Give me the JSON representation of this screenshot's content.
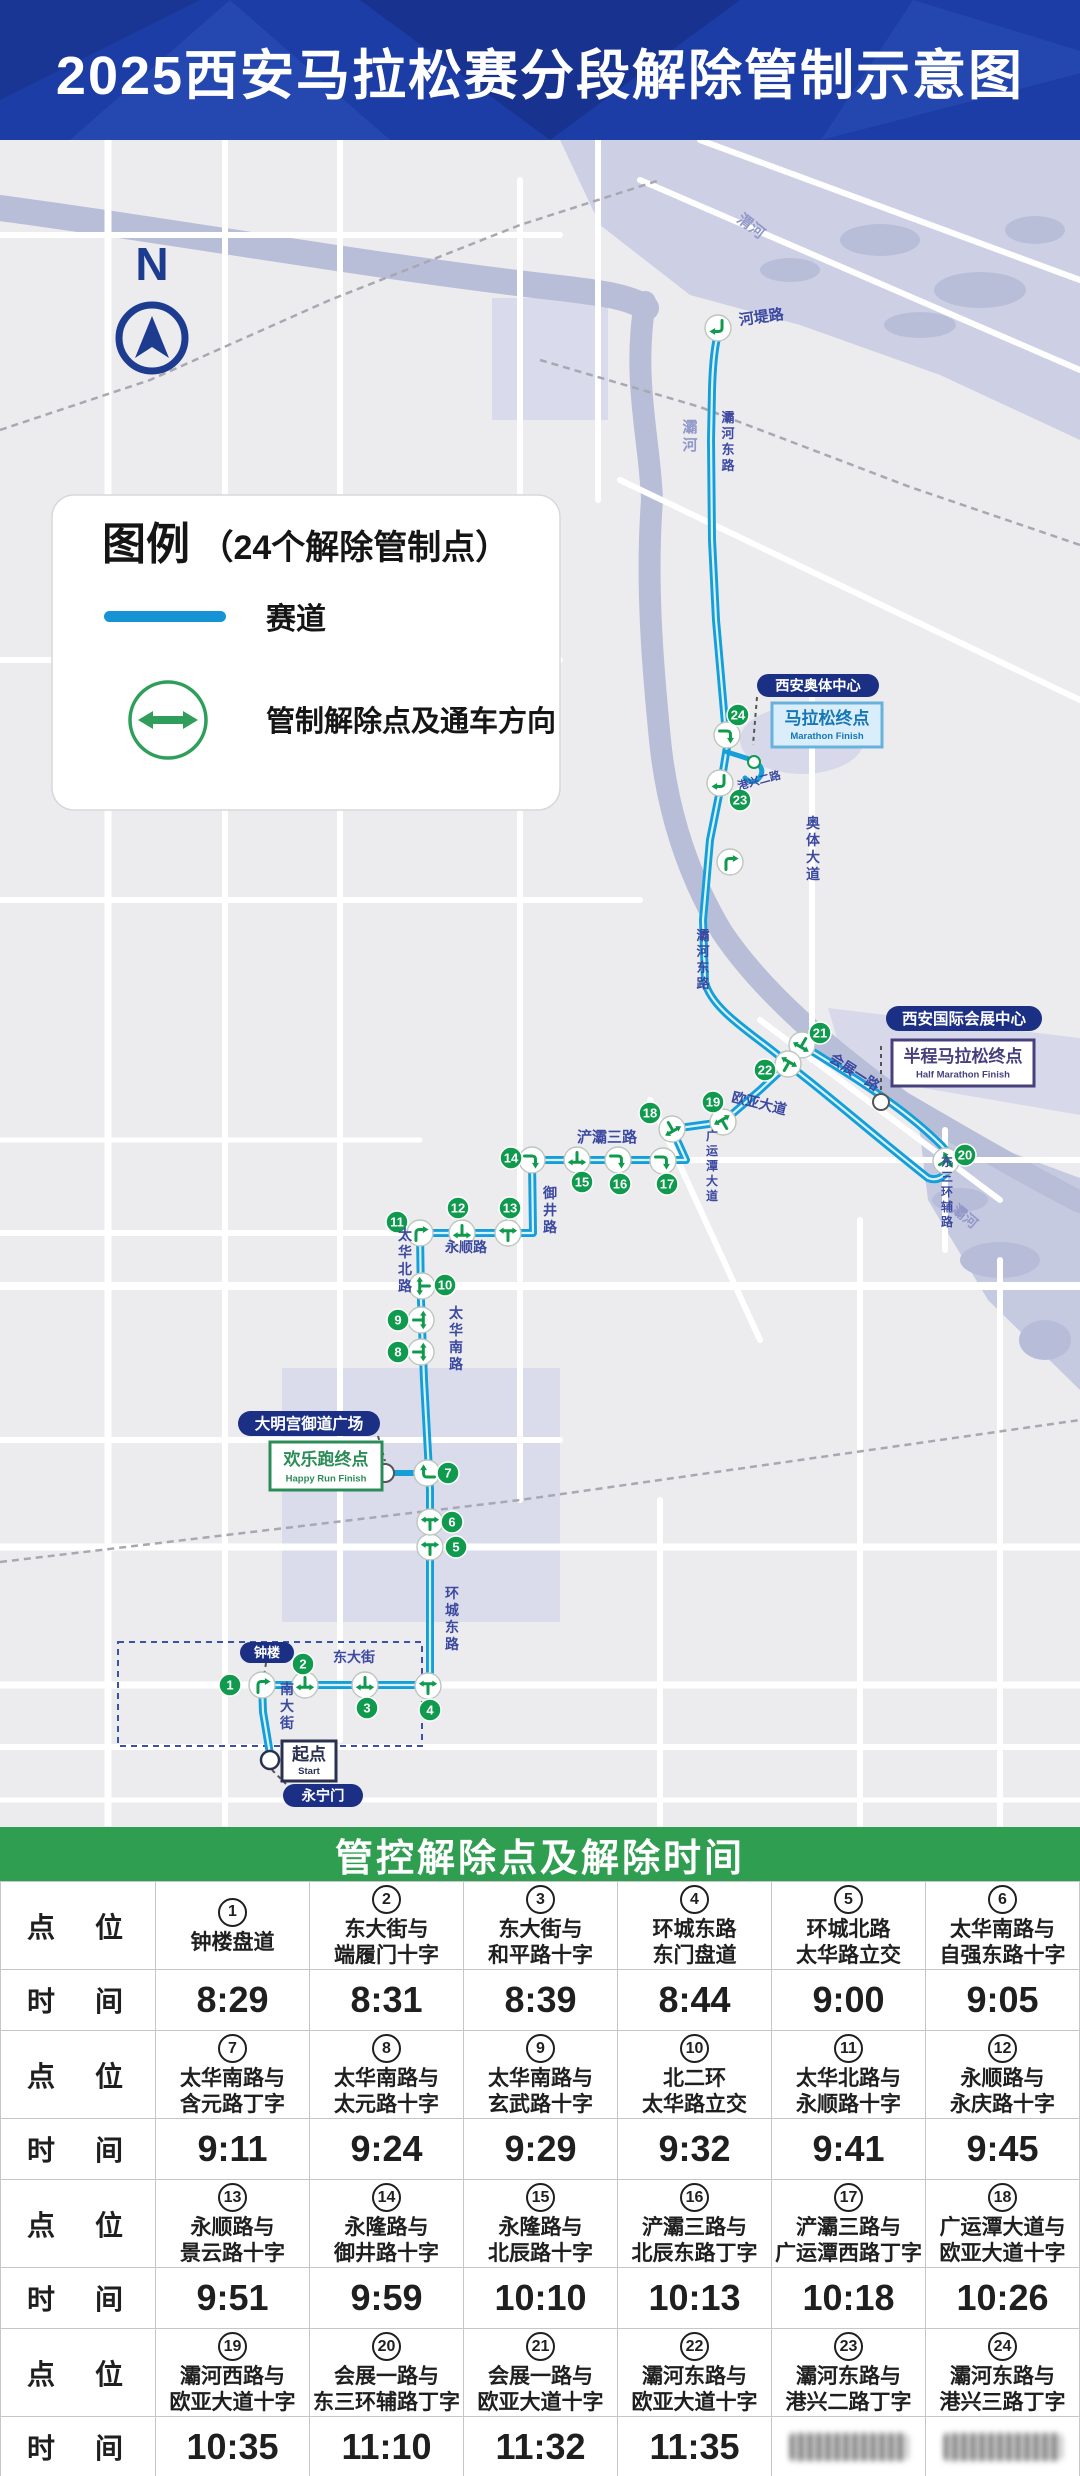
{
  "header": {
    "title": "2025西安马拉松赛分段解除管制示意图"
  },
  "colors": {
    "header_bg": "#1c3da5",
    "route": "#149fd9",
    "route_core": "#d9f1fb",
    "green": "#0f9a4e",
    "table_green": "#2f9e50",
    "navy": "#1d3c8f",
    "poi_navy": "#1b2f85",
    "road_label": "#3b49a0",
    "river_label": "#9298c8",
    "map_bg": "#ececef"
  },
  "map": {
    "compass": {
      "label": "N",
      "x": 152,
      "ytext": 140,
      "cx": 152,
      "cy": 198,
      "r": 33
    },
    "legend": {
      "x": 52,
      "y": 355,
      "w": 508,
      "h": 315,
      "title_main": "图例",
      "title_sub": "（24个解除管制点）",
      "track_label": "赛道",
      "release_label": "管制解除点及通车方向",
      "track_color": "#1593d4",
      "green": "#2f9e5a"
    },
    "patches": [
      {
        "pts": "560,0 1080,0 1080,300 940,235 800,185 690,155 600,85",
        "fill": "#cdd0e5"
      },
      {
        "pts": "492,158 608,158 608,280 492,280",
        "fill": "#d9dbec"
      },
      {
        "pts": "282,1228 560,1228 560,1482 282,1482",
        "fill": "#dadcec"
      },
      {
        "pts": "828,868 1080,898 1080,975 848,935",
        "fill": "#d7d9eb"
      },
      {
        "pts": "918,978 1080,1038 1080,1250 988,1160 928,1060",
        "fill": "#c6cae1"
      }
    ],
    "ellipses": [
      {
        "cx": 880,
        "cy": 100,
        "rx": 40,
        "ry": 16,
        "fill": "#b9bed8"
      },
      {
        "cx": 980,
        "cy": 150,
        "rx": 46,
        "ry": 18,
        "fill": "#b9bed8"
      },
      {
        "cx": 790,
        "cy": 130,
        "rx": 30,
        "ry": 12,
        "fill": "#b9bed8"
      },
      {
        "cx": 1035,
        "cy": 90,
        "rx": 30,
        "ry": 14,
        "fill": "#b9bed8"
      },
      {
        "cx": 920,
        "cy": 185,
        "rx": 36,
        "ry": 13,
        "fill": "#b9bed8"
      },
      {
        "cx": 802,
        "cy": 600,
        "rx": 62,
        "ry": 34,
        "fill": "#d7d9eb"
      },
      {
        "cx": 1000,
        "cy": 1120,
        "rx": 40,
        "ry": 18,
        "fill": "#b7bcd9"
      },
      {
        "cx": 1045,
        "cy": 1200,
        "rx": 26,
        "ry": 20,
        "fill": "#b7bcd9"
      },
      {
        "cx": 960,
        "cy": 1060,
        "rx": 28,
        "ry": 12,
        "fill": "#b7bcd9"
      }
    ],
    "rivers": [
      {
        "d": "M0,68 C180,92 380,128 560,148 C600,153 628,156 646,168",
        "w": 26
      },
      {
        "d": "M645,162 C632,240 650,300 652,360 C646,440 652,520 660,600 C668,680 692,742 722,792 C762,852 832,912 902,962 C962,997 1022,1032 1080,1062",
        "w": 22
      }
    ],
    "roads": [
      {
        "d": "M108,0 V1687",
        "w": 7
      },
      {
        "d": "M225,0 V1687",
        "w": 6
      },
      {
        "d": "M340,0 V1600",
        "w": 6
      },
      {
        "d": "M520,40 V1360",
        "w": 6
      },
      {
        "d": "M598,0 V360",
        "w": 6
      },
      {
        "d": "M860,1080 V1687",
        "w": 6
      },
      {
        "d": "M1000,1120 V1687",
        "w": 6
      },
      {
        "d": "M812,540 V920",
        "w": 6
      },
      {
        "d": "M945,990 V1110",
        "w": 6
      },
      {
        "d": "M660,1360 V1687",
        "w": 6
      },
      {
        "d": "M0,95 H560",
        "w": 6
      },
      {
        "d": "M0,520 H560",
        "w": 6
      },
      {
        "d": "M0,760 H640",
        "w": 6
      },
      {
        "d": "M0,1000 H420",
        "w": 5
      },
      {
        "d": "M0,1093 H533",
        "w": 6
      },
      {
        "d": "M0,1146 H1080",
        "w": 8
      },
      {
        "d": "M0,1300 H560",
        "w": 6
      },
      {
        "d": "M0,1407 H1080",
        "w": 7
      },
      {
        "d": "M0,1545 H1080",
        "w": 7
      },
      {
        "d": "M0,1607 H1080",
        "w": 6
      },
      {
        "d": "M0,1660 H1080",
        "w": 5
      },
      {
        "d": "M640,40 L1080,230",
        "w": 6
      },
      {
        "d": "M700,0 L1080,140",
        "w": 6
      },
      {
        "d": "M620,340 L1080,560",
        "w": 6
      },
      {
        "d": "M533,1020 H1080",
        "w": 6
      },
      {
        "d": "M650,960 L760,1200",
        "w": 6
      },
      {
        "d": "M760,880 L1000,1060",
        "w": 6
      }
    ],
    "rails": [
      {
        "d": "M0,290 L150,240 L330,160 L520,85 L660,40"
      },
      {
        "d": "M540,220 L700,267 L910,347 L1080,405"
      },
      {
        "d": "M0,1422 L520,1360 L1080,1280"
      }
    ],
    "wall": {
      "x": 118,
      "y": 1502,
      "w": 304,
      "h": 104
    },
    "route": {
      "d": "M272,1626 L263,1572 L262,1545 L430,1545 L430,1350 L424,1240 L421,1160 L420,1093 L533,1093 L532,1020 L686,1020 L672,989 L723,982 L760,950 L788,924 L802,905 C862,942 906,970 941,1005 Q957,1021 946,1033 Q938,1042 928,1038 C880,1000 842,967 808,940 Q794,929 786,922 C760,898 712,872 705,842 L703,780 L710,700 L720,650 L727,607 L723,560 L716,480 L712,400 L711,300 L712,250 Q713,212 718,194",
      "spurs": [
        {
          "d": "M727,612 Q740,616 752,620 Q766,627 760,637 Q753,646 745,638",
          "w": 5
        },
        {
          "d": "M392,1333 L415,1333",
          "w": 6
        }
      ]
    },
    "dashes": [
      {
        "d": "M266,1523 L263,1542"
      },
      {
        "d": "M378,1296 L385,1321"
      },
      {
        "d": "M272,1630 L286,1644"
      },
      {
        "d": "M757,557 L753,605"
      },
      {
        "d": "M881,906 L881,952"
      }
    ],
    "circles": [
      {
        "x": 270,
        "y": 1620,
        "r": 9,
        "s": "#2a3150",
        "w": 2.5
      },
      {
        "x": 385,
        "y": 1333,
        "r": 9,
        "s": "#555555",
        "w": 2
      },
      {
        "x": 881,
        "y": 962,
        "r": 8,
        "s": "#555555",
        "w": 2
      },
      {
        "x": 754,
        "y": 622,
        "r": 6,
        "s": "#0f9a4e",
        "w": 2
      }
    ],
    "junctions": [
      {
        "x": 262,
        "y": 1545,
        "t": "turn",
        "r": 0
      },
      {
        "x": 305,
        "y": 1545,
        "t": "tee",
        "r": 180
      },
      {
        "x": 365,
        "y": 1545,
        "t": "tee",
        "r": 180
      },
      {
        "x": 428,
        "y": 1546,
        "t": "tee",
        "r": 0
      },
      {
        "x": 430,
        "y": 1407,
        "t": "tee",
        "r": 0
      },
      {
        "x": 430,
        "y": 1382,
        "t": "tee",
        "r": 0
      },
      {
        "x": 427,
        "y": 1333,
        "t": "turn",
        "r": 270
      },
      {
        "x": 421,
        "y": 1212,
        "t": "tee",
        "r": 90
      },
      {
        "x": 421,
        "y": 1180,
        "t": "tee",
        "r": 90
      },
      {
        "x": 422,
        "y": 1146,
        "t": "tee",
        "r": 270
      },
      {
        "x": 420,
        "y": 1093,
        "t": "turn",
        "r": 0
      },
      {
        "x": 462,
        "y": 1093,
        "t": "tee",
        "r": 180
      },
      {
        "x": 508,
        "y": 1093,
        "t": "tee",
        "r": 0
      },
      {
        "x": 532,
        "y": 1020,
        "t": "turn",
        "r": 90
      },
      {
        "x": 577,
        "y": 1020,
        "t": "tee",
        "r": 180
      },
      {
        "x": 618,
        "y": 1020,
        "t": "turn",
        "r": 90
      },
      {
        "x": 663,
        "y": 1021,
        "t": "turn",
        "r": 90
      },
      {
        "x": 672,
        "y": 989,
        "t": "tee",
        "r": 150
      },
      {
        "x": 723,
        "y": 982,
        "t": "tee",
        "r": -30
      },
      {
        "x": 946,
        "y": 1021,
        "t": "tee",
        "r": 60
      },
      {
        "x": 802,
        "y": 905,
        "t": "tee",
        "r": 210
      },
      {
        "x": 788,
        "y": 924,
        "t": "tee",
        "r": 30
      },
      {
        "x": 720,
        "y": 643,
        "t": "turn",
        "r": 180
      },
      {
        "x": 727,
        "y": 595,
        "t": "turn",
        "r": 90
      },
      {
        "x": 718,
        "y": 188,
        "t": "turn",
        "r": 180
      },
      {
        "x": 730,
        "y": 722,
        "t": "turn",
        "r": 0
      }
    ],
    "badges": [
      {
        "n": "1",
        "x": 230,
        "y": 1545
      },
      {
        "n": "2",
        "x": 303,
        "y": 1524
      },
      {
        "n": "3",
        "x": 367,
        "y": 1568
      },
      {
        "n": "4",
        "x": 430,
        "y": 1570
      },
      {
        "n": "5",
        "x": 456,
        "y": 1407
      },
      {
        "n": "6",
        "x": 452,
        "y": 1382
      },
      {
        "n": "7",
        "x": 448,
        "y": 1333
      },
      {
        "n": "8",
        "x": 398,
        "y": 1212
      },
      {
        "n": "9",
        "x": 398,
        "y": 1180
      },
      {
        "n": "10",
        "x": 445,
        "y": 1145
      },
      {
        "n": "11",
        "x": 397,
        "y": 1082
      },
      {
        "n": "12",
        "x": 458,
        "y": 1068
      },
      {
        "n": "13",
        "x": 510,
        "y": 1068
      },
      {
        "n": "14",
        "x": 511,
        "y": 1018
      },
      {
        "n": "15",
        "x": 582,
        "y": 1042
      },
      {
        "n": "16",
        "x": 620,
        "y": 1044
      },
      {
        "n": "17",
        "x": 667,
        "y": 1044
      },
      {
        "n": "18",
        "x": 650,
        "y": 973
      },
      {
        "n": "19",
        "x": 713,
        "y": 962
      },
      {
        "n": "20",
        "x": 965,
        "y": 1015
      },
      {
        "n": "21",
        "x": 820,
        "y": 893
      },
      {
        "n": "22",
        "x": 765,
        "y": 930
      },
      {
        "n": "23",
        "x": 740,
        "y": 660
      },
      {
        "n": "24",
        "x": 738,
        "y": 575
      }
    ],
    "labels": [
      {
        "t": "河堤路",
        "x": 762,
        "y": 182,
        "s": 15,
        "rot": -8
      },
      {
        "t": "渭河",
        "x": 748,
        "y": 90,
        "s": 15,
        "rot": 38,
        "c": "#9298c8"
      },
      {
        "t": "灞河",
        "x": 690,
        "y": 292,
        "v": 1,
        "s": 15,
        "c": "#9298c8"
      },
      {
        "t": "灞河东路",
        "x": 728,
        "y": 282,
        "v": 1,
        "s": 13
      },
      {
        "t": "灞河东路",
        "x": 703,
        "y": 800,
        "v": 1,
        "s": 13
      },
      {
        "t": "奥体大道",
        "x": 813,
        "y": 688,
        "v": 1,
        "s": 14
      },
      {
        "t": "港兴二路",
        "x": 760,
        "y": 644,
        "s": 11,
        "rot": -15
      },
      {
        "t": "会展一路",
        "x": 852,
        "y": 936,
        "s": 14,
        "rot": 33
      },
      {
        "t": "欧亚大道",
        "x": 758,
        "y": 968,
        "s": 14,
        "rot": 14
      },
      {
        "t": "东三环辅路",
        "x": 947,
        "y": 1026,
        "v": 1,
        "s": 12
      },
      {
        "t": "广运潭大道",
        "x": 712,
        "y": 1000,
        "v": 1,
        "s": 12
      },
      {
        "t": "浐灞三路",
        "x": 607,
        "y": 1002,
        "s": 15
      },
      {
        "t": "御井路",
        "x": 550,
        "y": 1058,
        "v": 1,
        "s": 14
      },
      {
        "t": "永顺路",
        "x": 466,
        "y": 1112,
        "s": 14
      },
      {
        "t": "太华北路",
        "x": 405,
        "y": 1100,
        "v": 1,
        "s": 14
      },
      {
        "t": "太华南路",
        "x": 456,
        "y": 1178,
        "v": 1,
        "s": 14
      },
      {
        "t": "环城东路",
        "x": 452,
        "y": 1458,
        "v": 1,
        "s": 14
      },
      {
        "t": "东大街",
        "x": 354,
        "y": 1522,
        "s": 14
      },
      {
        "t": "南大街",
        "x": 287,
        "y": 1554,
        "v": 1,
        "s": 14
      },
      {
        "t": "灞河",
        "x": 962,
        "y": 1080,
        "s": 14,
        "rot": 40,
        "c": "#9298c8"
      }
    ],
    "pois": [
      {
        "type": "pill",
        "x": 757,
        "y": 534,
        "w": 122,
        "h": 23,
        "label": "西安奥体中心"
      },
      {
        "type": "box",
        "x": 772,
        "y": 563,
        "w": 110,
        "h": 44,
        "title": "马拉松终点",
        "sub": "Marathon Finish",
        "bg": "#d9eefa",
        "border": "#68b1dc",
        "color": "#1777b5"
      },
      {
        "type": "pill",
        "x": 886,
        "y": 866,
        "w": 156,
        "h": 25,
        "label": "西安国际会展中心"
      },
      {
        "type": "box",
        "x": 892,
        "y": 900,
        "w": 142,
        "h": 46,
        "title": "半程马拉松终点",
        "sub": "Half Marathon Finish",
        "bg": "#ffffff",
        "border": "#47407e",
        "color": "#47407e"
      },
      {
        "type": "pill",
        "x": 238,
        "y": 1271,
        "w": 142,
        "h": 25,
        "label": "大明宫御道广场"
      },
      {
        "type": "box",
        "x": 270,
        "y": 1302,
        "w": 112,
        "h": 48,
        "title": "欢乐跑终点",
        "sub": "Happy Run Finish",
        "bg": "#ffffff",
        "border": "#2c8c57",
        "color": "#2c8c57"
      },
      {
        "type": "pill",
        "x": 240,
        "y": 1502,
        "w": 54,
        "h": 21,
        "label": "钟楼"
      },
      {
        "type": "box",
        "x": 282,
        "y": 1601,
        "w": 54,
        "h": 40,
        "title": "起点",
        "sub": "Start",
        "bg": "#ffffff",
        "border": "#2a3150",
        "color": "#2a3150"
      },
      {
        "type": "pill",
        "x": 283,
        "y": 1644,
        "w": 80,
        "h": 23,
        "label": "永宁门"
      }
    ]
  },
  "table": {
    "header": "管控解除点及解除时间",
    "row_labels": {
      "point": "点　位",
      "time": "时　间"
    },
    "groups": [
      {
        "points": [
          {
            "no": "1",
            "name": "钟楼盘道"
          },
          {
            "no": "2",
            "name": "东大街与\n端履门十字"
          },
          {
            "no": "3",
            "name": "东大街与\n和平路十字"
          },
          {
            "no": "4",
            "name": "环城东路\n东门盘道"
          },
          {
            "no": "5",
            "name": "环城北路\n太华路立交"
          },
          {
            "no": "6",
            "name": "太华南路与\n自强东路十字"
          }
        ],
        "times": [
          "8:29",
          "8:31",
          "8:39",
          "8:44",
          "9:00",
          "9:05"
        ]
      },
      {
        "points": [
          {
            "no": "7",
            "name": "太华南路与\n含元路丁字"
          },
          {
            "no": "8",
            "name": "太华南路与\n太元路十字"
          },
          {
            "no": "9",
            "name": "太华南路与\n玄武路十字"
          },
          {
            "no": "10",
            "name": "北二环\n太华路立交"
          },
          {
            "no": "11",
            "name": "太华北路与\n永顺路十字"
          },
          {
            "no": "12",
            "name": "永顺路与\n永庆路十字"
          }
        ],
        "times": [
          "9:11",
          "9:24",
          "9:29",
          "9:32",
          "9:41",
          "9:45"
        ]
      },
      {
        "points": [
          {
            "no": "13",
            "name": "永顺路与\n景云路十字"
          },
          {
            "no": "14",
            "name": "永隆路与\n御井路十字"
          },
          {
            "no": "15",
            "name": "永隆路与\n北辰路十字"
          },
          {
            "no": "16",
            "name": "浐灞三路与\n北辰东路丁字"
          },
          {
            "no": "17",
            "name": "浐灞三路与\n广运潭西路丁字"
          },
          {
            "no": "18",
            "name": "广运潭大道与\n欧亚大道十字"
          }
        ],
        "times": [
          "9:51",
          "9:59",
          "10:10",
          "10:13",
          "10:18",
          "10:26"
        ]
      },
      {
        "points": [
          {
            "no": "19",
            "name": "灞河西路与\n欧亚大道十字"
          },
          {
            "no": "20",
            "name": "会展一路与\n东三环辅路丁字"
          },
          {
            "no": "21",
            "name": "会展一路与\n欧亚大道十字"
          },
          {
            "no": "22",
            "name": "灞河东路与\n欧亚大道十字"
          },
          {
            "no": "23",
            "name": "灞河东路与\n港兴二路丁字"
          },
          {
            "no": "24",
            "name": "灞河东路与\n港兴三路丁字"
          }
        ],
        "times": [
          "10:35",
          "11:10",
          "11:32",
          "11:35",
          {
            "blurred": true
          },
          {
            "blurred": true
          }
        ]
      }
    ]
  }
}
